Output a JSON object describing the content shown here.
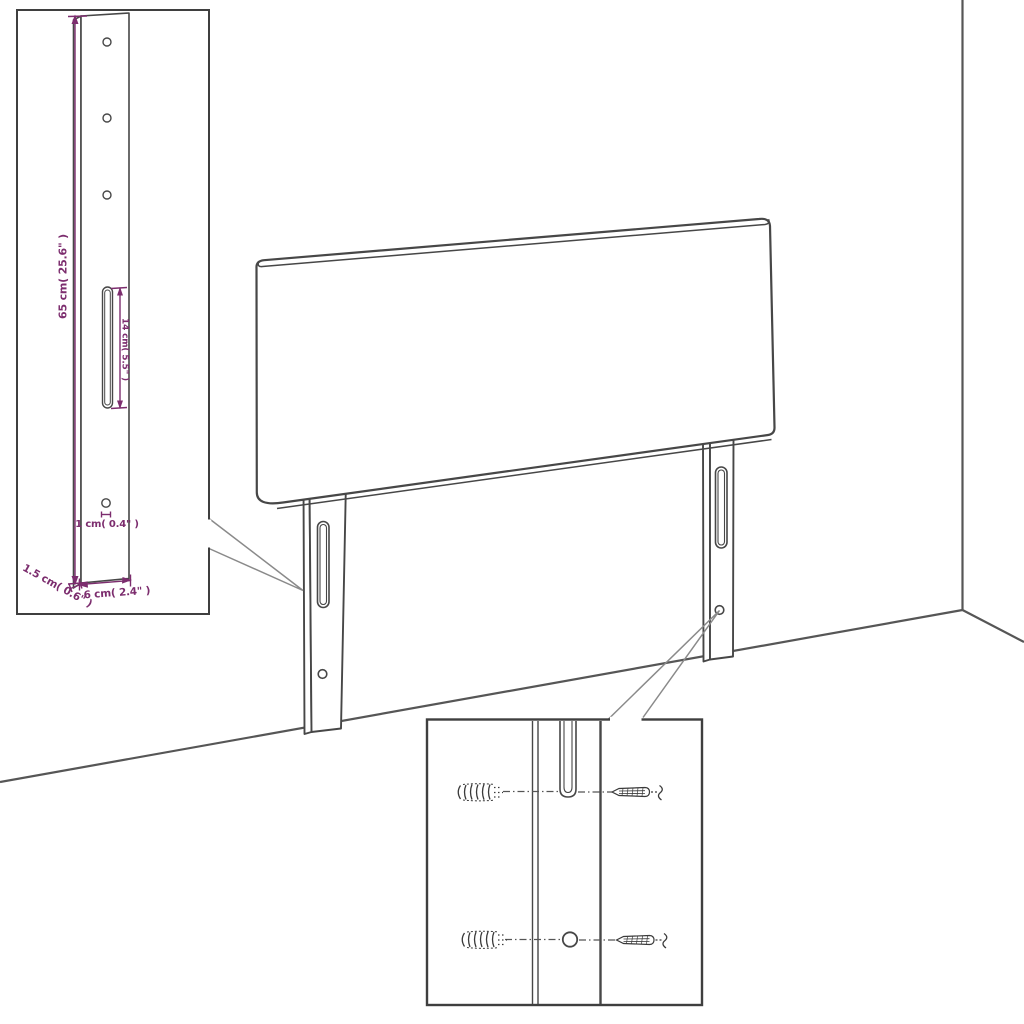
{
  "colors": {
    "background": "#ffffff",
    "drawing_line": "#474747",
    "inset_border": "#3f3f3f",
    "dimension": "#7c2d6e",
    "callout_line": "#8a8a8a"
  },
  "labels": {
    "leg_height": "65 cm( 25.6\" )",
    "slot_length": "14 cm( 5.5\" )",
    "hole_diameter": "1 cm( 0.4\" )",
    "leg_thickness": "1.5 cm( 0.6\" )",
    "leg_width": "6 cm( 2.4\" )"
  },
  "icons": {
    "anchor": "wall-plug-anchor",
    "screw": "mounting-screw"
  }
}
